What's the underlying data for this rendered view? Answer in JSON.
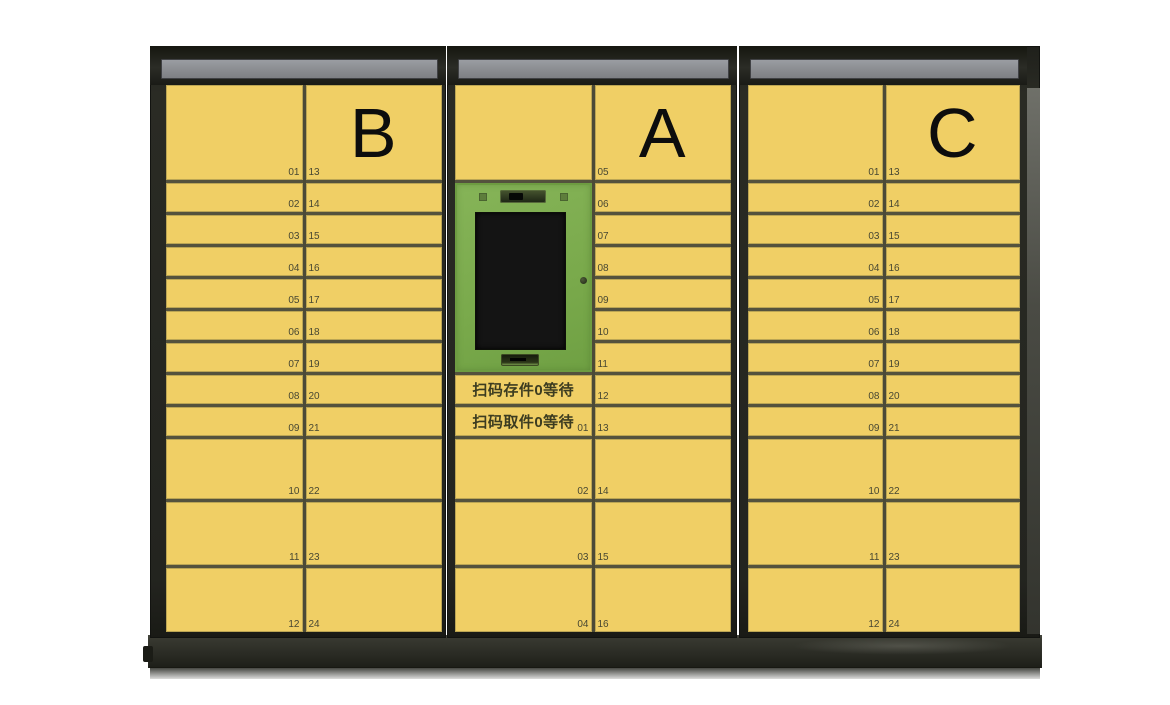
{
  "scene": {
    "name": "智能快递柜",
    "description": "Smart parcel locker bank with three yellow cabinets (B, A, C) and a central green kiosk panel"
  },
  "colors": {
    "door_yellow": "#f0cf65",
    "grid_line": "#54523d",
    "frame_dark": "#24251f",
    "sign_gray": "#8f9296",
    "kiosk_green": "#7fae52",
    "screen_black": "#141414",
    "number_text": "#474732",
    "status_text": "#3c3c20"
  },
  "cabinets": [
    {
      "letter": "B",
      "rows": [
        {
          "left": "01",
          "right": "13"
        },
        {
          "left": "02",
          "right": "14"
        },
        {
          "left": "03",
          "right": "15"
        },
        {
          "left": "04",
          "right": "16"
        },
        {
          "left": "05",
          "right": "17"
        },
        {
          "left": "06",
          "right": "18"
        },
        {
          "left": "07",
          "right": "19"
        },
        {
          "left": "08",
          "right": "20"
        },
        {
          "left": "09",
          "right": "21"
        },
        {
          "left": "10",
          "right": "22"
        },
        {
          "left": "11",
          "right": "23"
        },
        {
          "left": "12",
          "right": "24"
        }
      ]
    },
    {
      "letter": "A",
      "kiosk": {
        "deposit_status": "扫码存件0等待",
        "pickup_status": "扫码取件0等待"
      },
      "left": {
        "pickup_num": "01",
        "row_02": "02",
        "row_03": "03",
        "row_04": "04"
      },
      "right_numbers": [
        "05",
        "06",
        "07",
        "08",
        "09",
        "10",
        "11",
        "12",
        "13",
        "14",
        "15",
        "16"
      ]
    },
    {
      "letter": "C",
      "rows": [
        {
          "left": "01",
          "right": "13"
        },
        {
          "left": "02",
          "right": "14"
        },
        {
          "left": "03",
          "right": "15"
        },
        {
          "left": "04",
          "right": "16"
        },
        {
          "left": "05",
          "right": "17"
        },
        {
          "left": "06",
          "right": "18"
        },
        {
          "left": "07",
          "right": "19"
        },
        {
          "left": "08",
          "right": "20"
        },
        {
          "left": "09",
          "right": "21"
        },
        {
          "left": "10",
          "right": "22"
        },
        {
          "left": "11",
          "right": "23"
        },
        {
          "left": "12",
          "right": "24"
        }
      ]
    }
  ]
}
